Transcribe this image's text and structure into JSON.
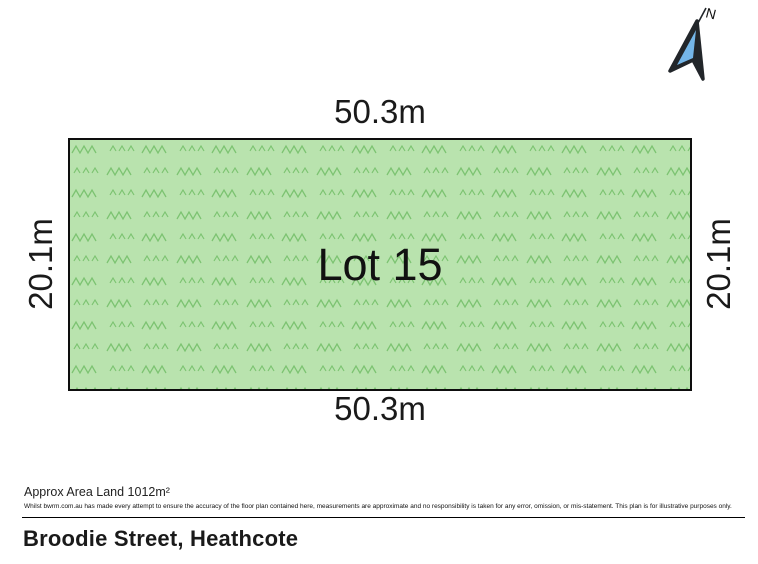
{
  "compass": {
    "label": "N"
  },
  "plan": {
    "lot_label": "Lot 15",
    "top_dim": "50.3m",
    "bottom_dim": "50.3m",
    "left_dim": "20.1m",
    "right_dim": "20.1m"
  },
  "footer": {
    "area_label": "Approx Area Land 1012m²",
    "disclaimer": "Whilst bwrm.com.au has made every attempt to ensure the accuracy of the floor plan contained here, measurements are approximate and no responsibility is taken for any error, omission, or mis-statement. This plan is for illustrative purposes only.",
    "address": "Broodie Street, Heathcote"
  },
  "colors": {
    "grass_fill": "#b9e3ae",
    "grass_stroke": "#7cc371",
    "plan_border": "#0e0e0e",
    "compass_dark": "#22262a",
    "compass_blue": "#74b6e8"
  }
}
